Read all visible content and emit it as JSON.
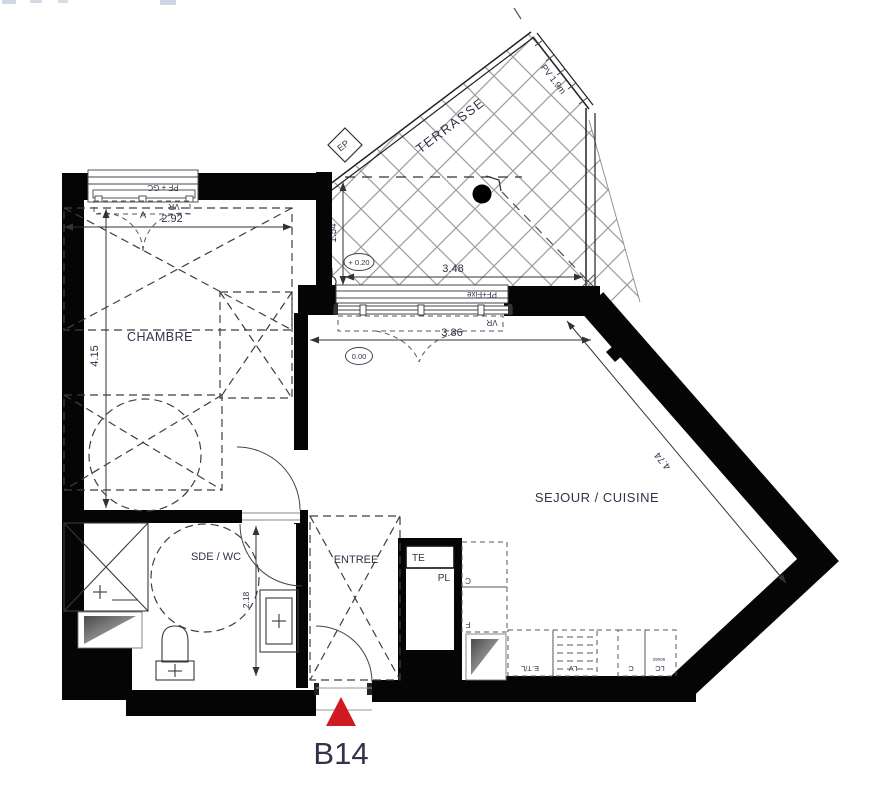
{
  "unit": {
    "label": "B14"
  },
  "rooms": {
    "chambre": "CHAMBRE",
    "sde_wc": "SDE / WC",
    "entree": "ENTREE",
    "sejour_cuisine": "SEJOUR / CUISINE",
    "terrasse": "TERRASSE"
  },
  "dimensions": {
    "chambre_width": "2.92",
    "chambre_depth": "4.15",
    "terrasse_depth": "1.54",
    "terrasse_width": "3.48",
    "bay_width": "3.86",
    "sejour_diagonal": "4.74",
    "sde_depth": "2.18"
  },
  "levels": {
    "terrasse": "+ 0.20",
    "interior": "0.00"
  },
  "openings": {
    "chambre_window": "PF + GC",
    "chambre_shutter": "VR",
    "bay_window": "PF+Fixe",
    "bay_shutter": "VR",
    "privacy_screen": "PV 1.9m"
  },
  "annotations": {
    "ep_top": "EP",
    "ep_bottom": "EP",
    "section_mark": "A",
    "electrical_panel": "TE",
    "closet": "PL",
    "column": "C",
    "fridge": "F",
    "sink_cooktop": "E.T/L",
    "dishwasher": "LV",
    "cooktop": "C",
    "washer": "LC",
    "washer_size": "60x60"
  },
  "colors": {
    "marker": "#d01a22",
    "walls": "#050505",
    "hatch": "#9c9c9c",
    "text": "#32324a"
  }
}
